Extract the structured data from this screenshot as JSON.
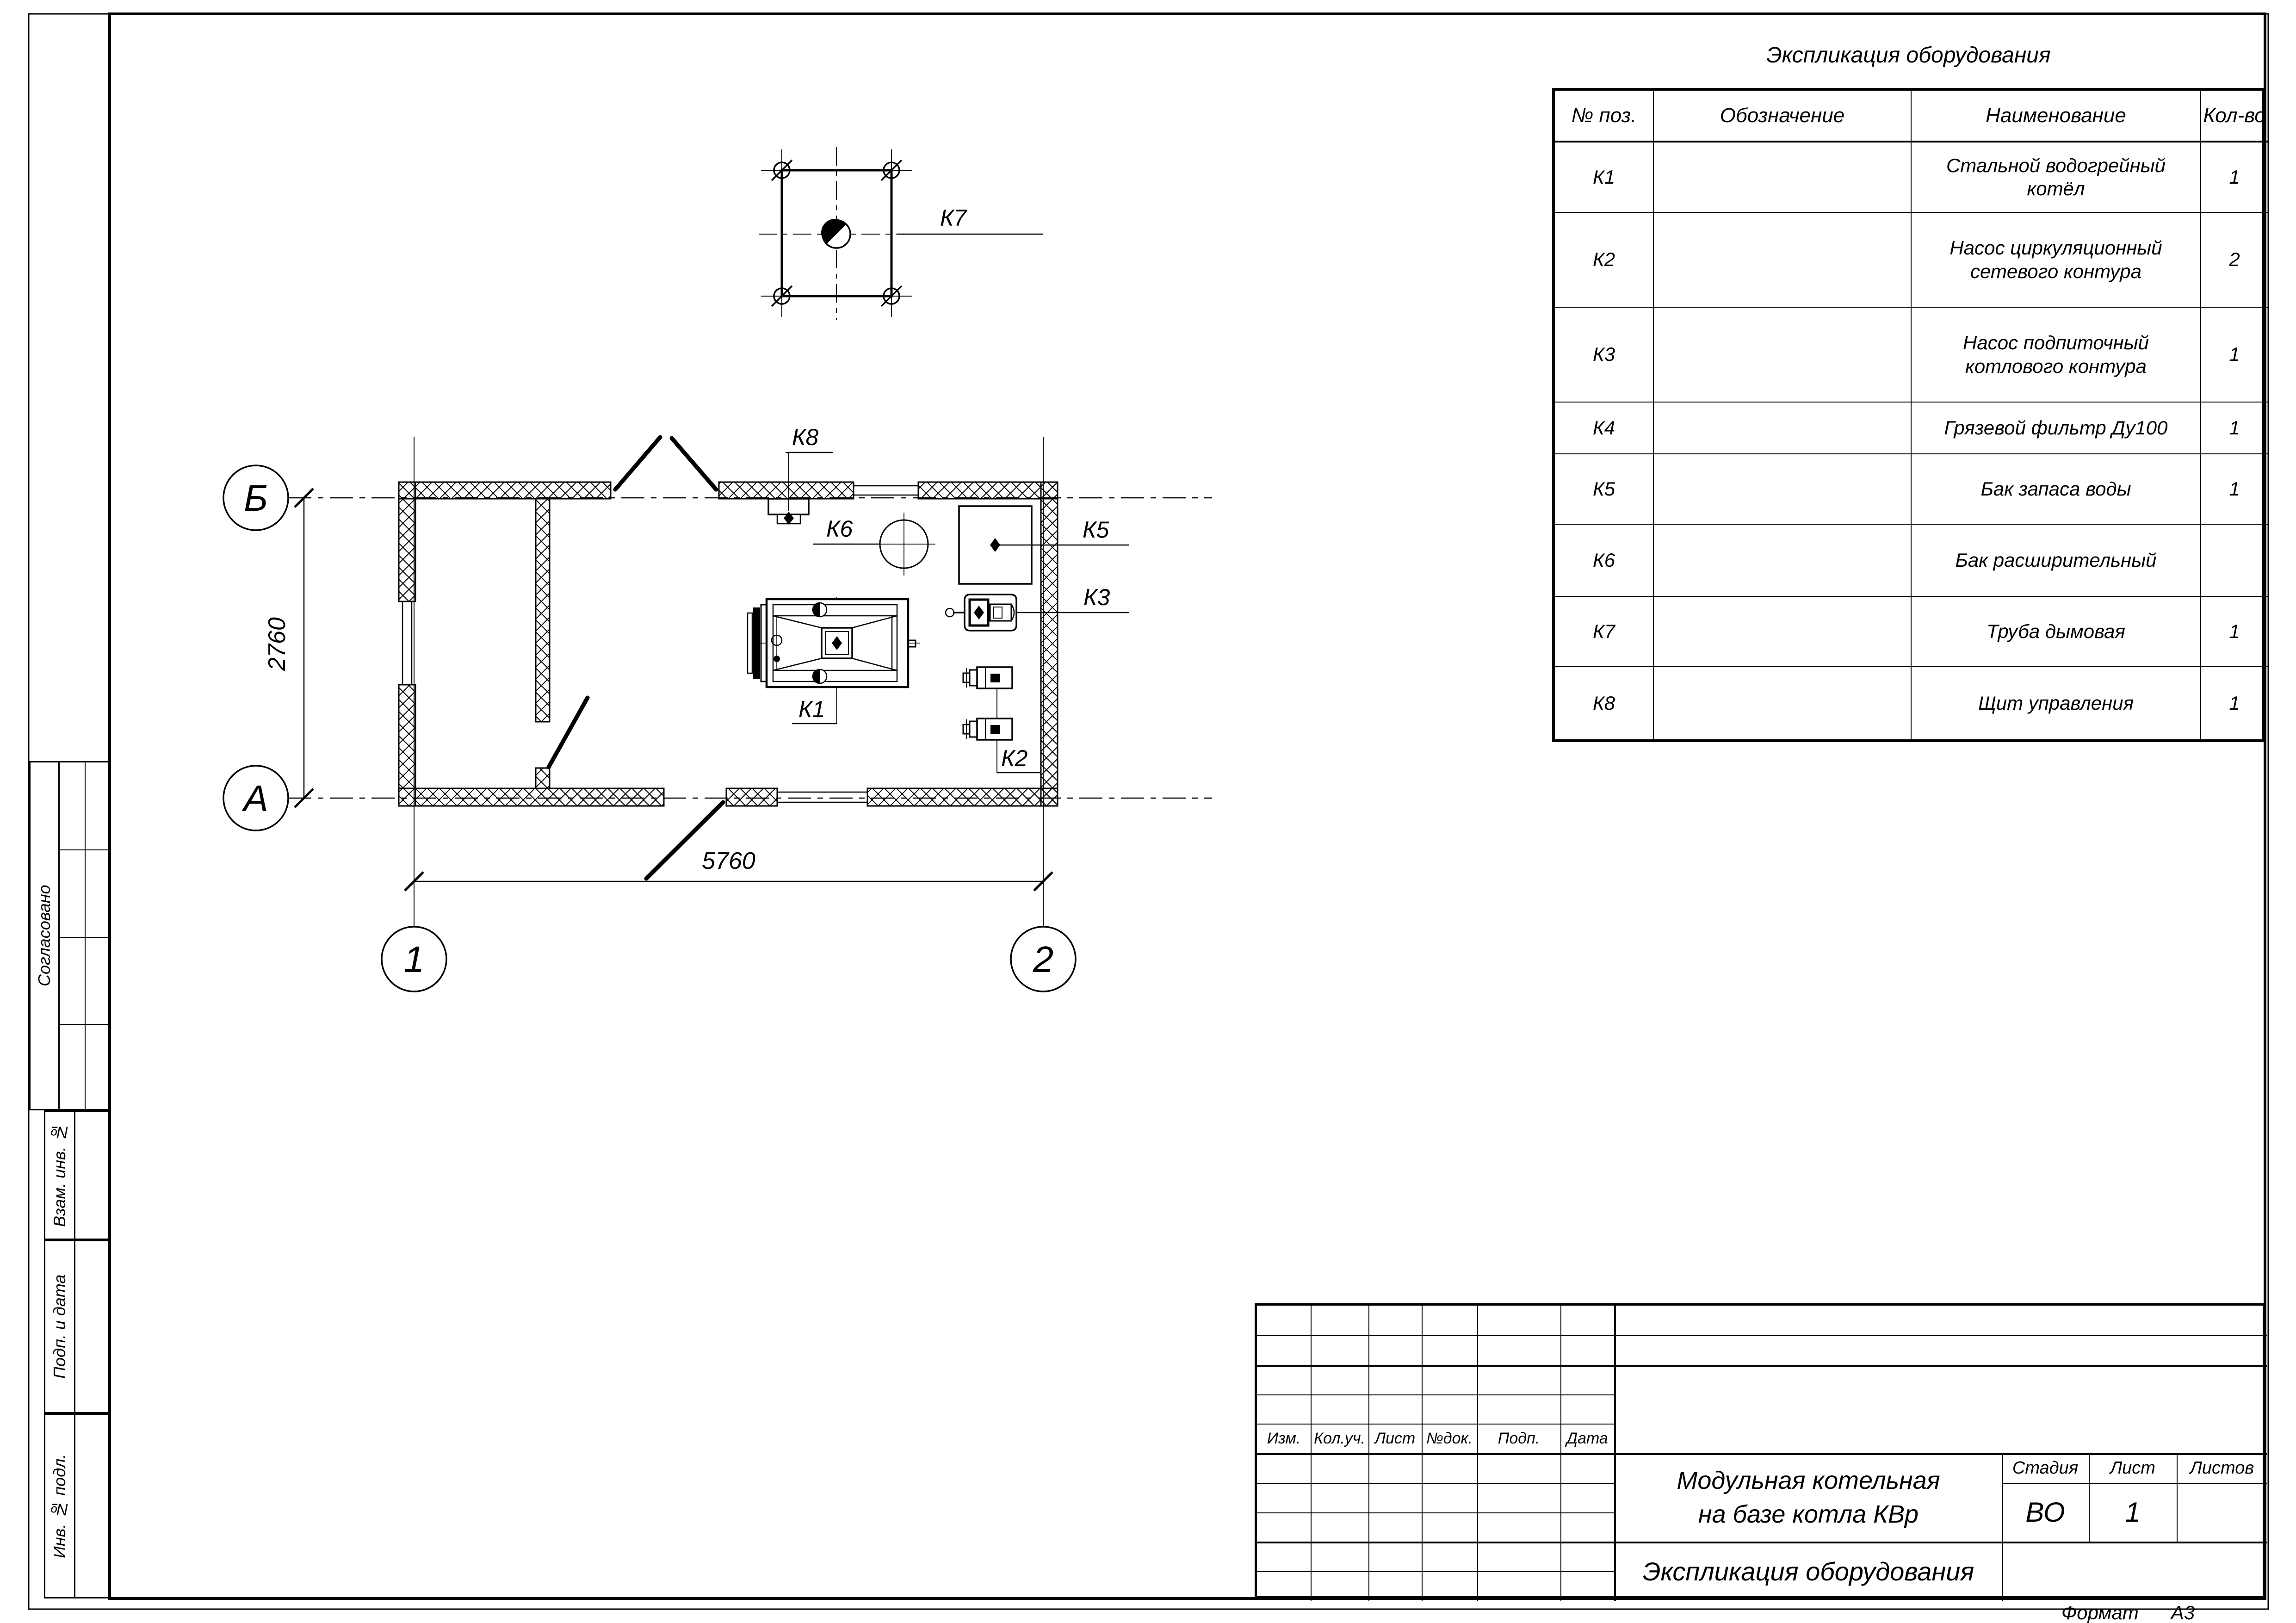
{
  "equipment_table": {
    "title": "Экспликация оборудования",
    "headers": {
      "pos": "№ поз.",
      "designation": "Обозначение",
      "name": "Наименование",
      "qty": "Кол-во"
    },
    "rows": [
      {
        "pos": "К1",
        "designation": "",
        "name": "Стальной водогрейный котёл",
        "qty": "1"
      },
      {
        "pos": "К2",
        "designation": "",
        "name": "Насос циркуляционный сетевого контура",
        "qty": "2"
      },
      {
        "pos": "К3",
        "designation": "",
        "name": "Насос подпиточный котлового контура",
        "qty": "1"
      },
      {
        "pos": "К4",
        "designation": "",
        "name": "Грязевой фильтр Ду100",
        "qty": "1"
      },
      {
        "pos": "К5",
        "designation": "",
        "name": "Бак запаса воды",
        "qty": "1"
      },
      {
        "pos": "К6",
        "designation": "",
        "name": "Бак расширительный",
        "qty": ""
      },
      {
        "pos": "К7",
        "designation": "",
        "name": "Труба дымовая",
        "qty": "1"
      },
      {
        "pos": "К8",
        "designation": "",
        "name": "Щит управления",
        "qty": "1"
      }
    ]
  },
  "plan": {
    "axes": {
      "b": "Б",
      "a": "А",
      "n1": "1",
      "n2": "2"
    },
    "dimensions": {
      "horizontal": "5760",
      "vertical": "2760"
    },
    "labels": {
      "k1": "К1",
      "k2": "К2",
      "k3": "К3",
      "k5": "К5",
      "k6": "К6",
      "k7": "К7",
      "k8": "К8"
    }
  },
  "title_block": {
    "object_title_line1": "Модульная котельная",
    "object_title_line2": "на базе котла КВр",
    "sheet_title": "Экспликация оборудования",
    "stage_label": "Стадия",
    "sheet_label": "Лист",
    "sheets_label": "Листов",
    "stage_value": "ВО",
    "sheet_value": "1",
    "sheets_value": "",
    "revision_columns": {
      "izm": "Изм.",
      "koluch": "Кол.уч.",
      "list": "Лист",
      "ndok": "№док.",
      "podp": "Подп.",
      "data": "Дата"
    }
  },
  "side_column": {
    "agreed": "Согласовано",
    "vzam": "Взам. инв. №",
    "podp_i_data": "Подп. и дата",
    "inv_podl": "Инв. № подл."
  },
  "sheet": {
    "format_label": "Формат",
    "format_value": "А3"
  }
}
